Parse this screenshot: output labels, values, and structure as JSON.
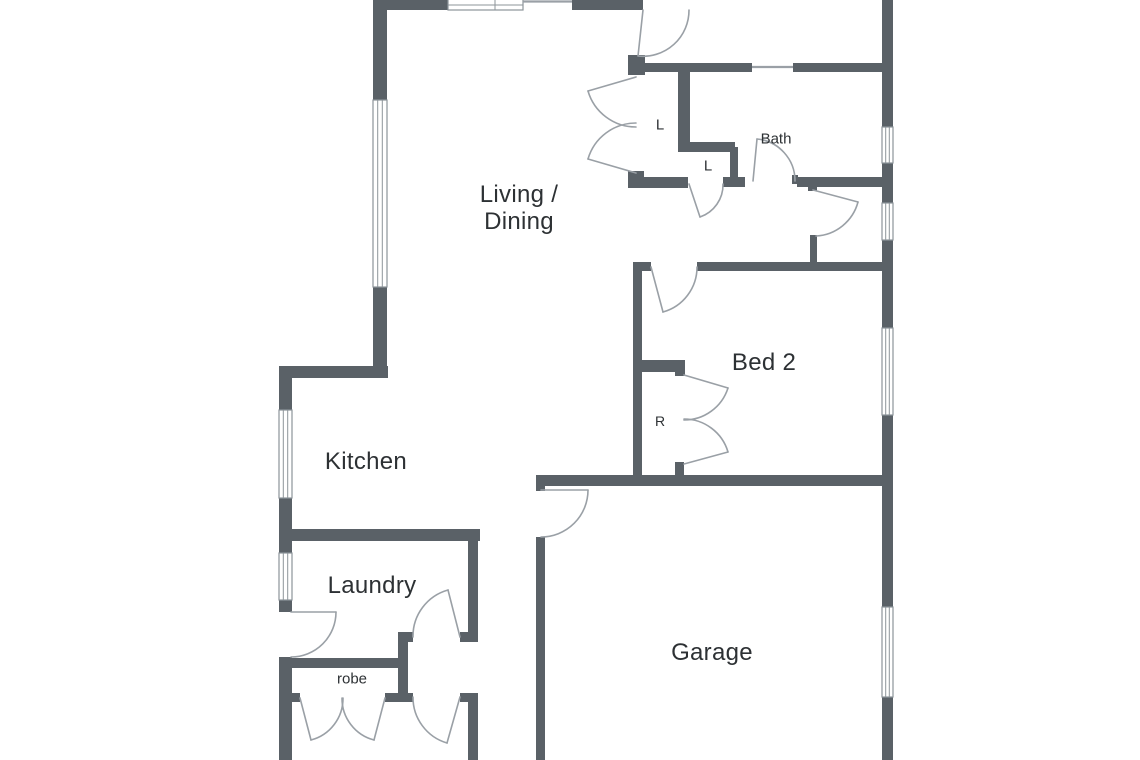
{
  "floor_plan": {
    "type": "residential-floor-plan",
    "colors": {
      "background": "#ffffff",
      "wall": "#5a6167",
      "thin_line": "#9aa0a6",
      "window_border": "#8d949a",
      "text": "#2d3134"
    },
    "rooms": {
      "living_dining": {
        "label_line1": "Living /",
        "label_line2": "Dining"
      },
      "kitchen": {
        "label": "Kitchen"
      },
      "laundry": {
        "label": "Laundry"
      },
      "robe": {
        "label": "robe"
      },
      "garage": {
        "label": "Garage"
      },
      "bed2": {
        "label": "Bed 2"
      },
      "bath": {
        "label": "Bath"
      },
      "linen_1": {
        "label": "L"
      },
      "linen_2": {
        "label": "L"
      },
      "bed2_robe": {
        "label": "R"
      }
    }
  }
}
